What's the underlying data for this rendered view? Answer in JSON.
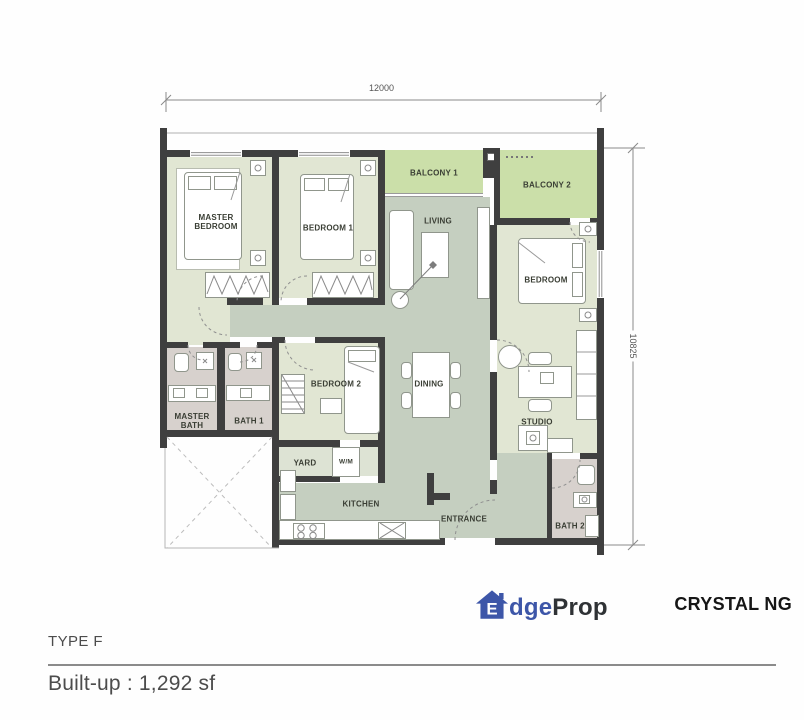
{
  "plan": {
    "dim_width": "12000",
    "dim_height": "10825",
    "rooms": {
      "master_bedroom": "MASTER BEDROOM",
      "bedroom_1": "BEDROOM 1",
      "bedroom_2": "BEDROOM 2",
      "bedroom": "BEDROOM",
      "living": "LIVING",
      "dining": "DINING",
      "studio": "STUDIO",
      "kitchen": "KITCHEN",
      "entrance": "ENTRANCE",
      "yard": "YARD",
      "balcony_1": "BALCONY 1",
      "balcony_2": "BALCONY 2",
      "master_bath": "MASTER BATH",
      "bath_1": "BATH 1",
      "bath_2": "BATH 2",
      "washing_machine": "W/M"
    },
    "colors": {
      "wall": "#3f3f3f",
      "room_fill": "#e1e6d3",
      "balcony_fill": "#cbdfa9",
      "floor_fill": "#c5cfc0",
      "bath_fill": "#d7d1cd"
    }
  },
  "footer": {
    "type_label": "TYPE F",
    "builtup_label": "Built-up : 1,292 sf"
  },
  "branding": {
    "logo_letter": "E",
    "logo_text_blue": "dge",
    "logo_text_dark": "Prop",
    "brand_blue": "#3d56a8",
    "agent_name": "CRYSTAL NG"
  }
}
